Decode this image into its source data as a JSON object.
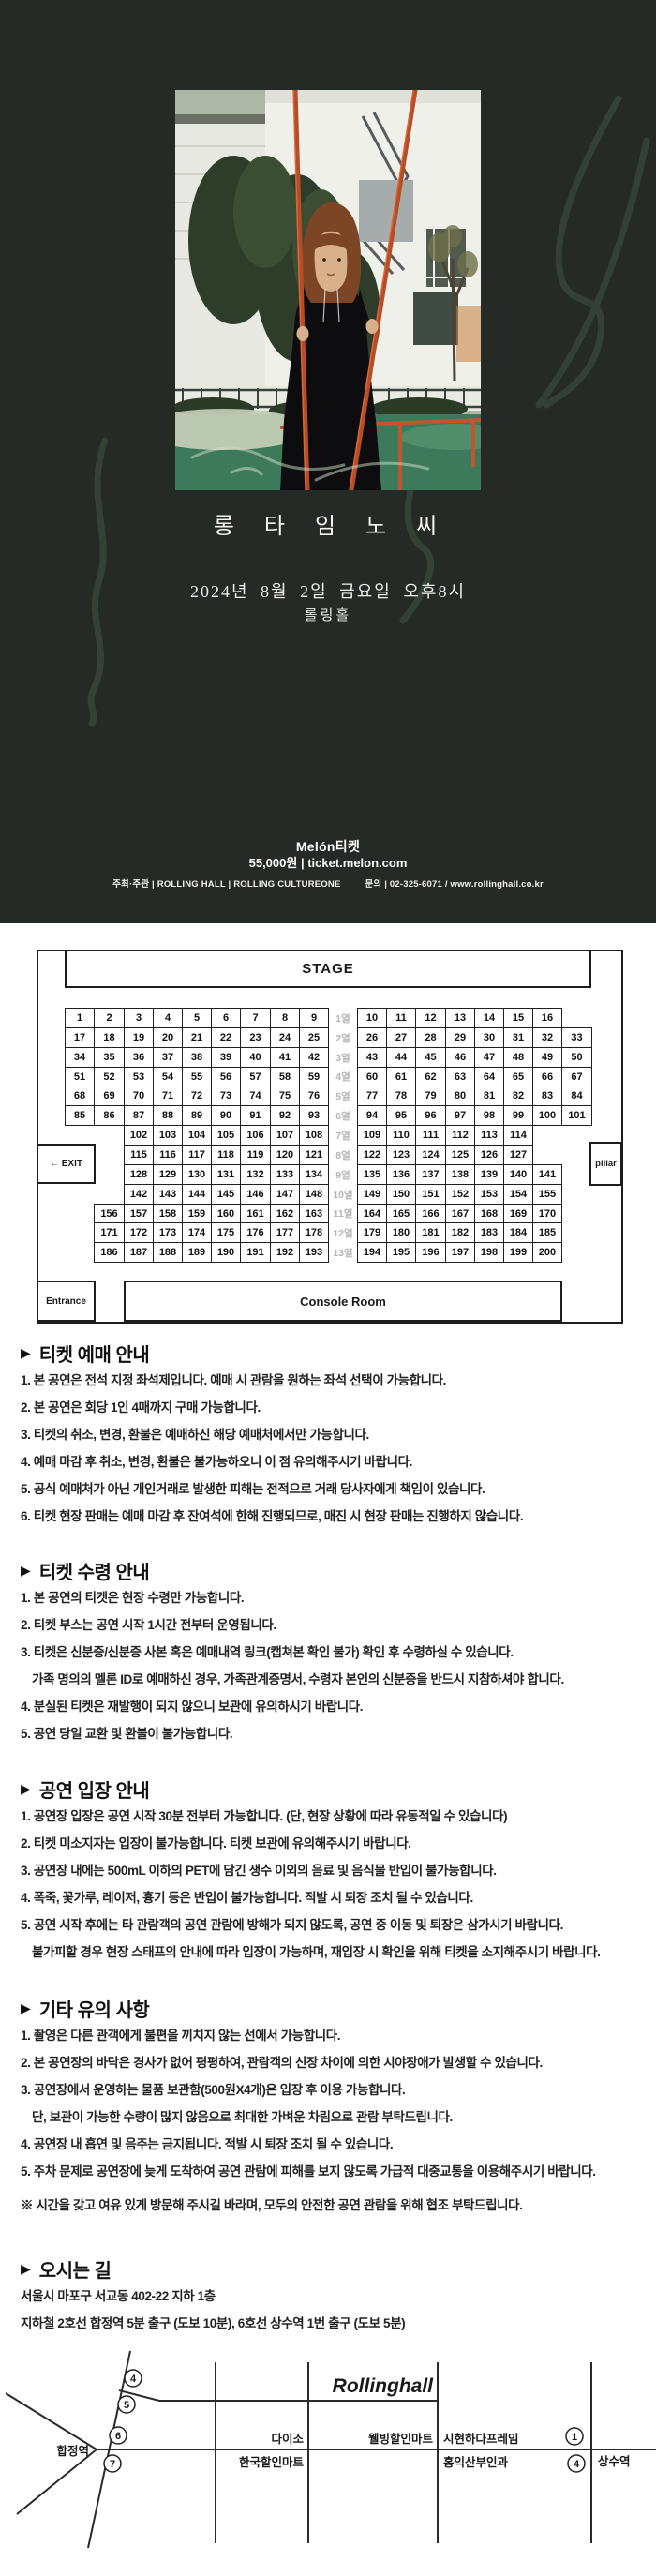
{
  "hero": {
    "title": "롱 타 임 노 씨",
    "date": "2024년 8월 2일 금요일 오후8시",
    "venue": "롤링홀",
    "brand": "Melón티켓",
    "price_line": "55,000원 | ticket.melon.com",
    "credits_left": "주최·주관 | ROLLING HALL | ROLLING CULTUREONE",
    "credits_right": "문의 | 02-325-6071 / www.rollinghall.co.kr"
  },
  "seatmap": {
    "stage_label": "STAGE",
    "exit_label": "← EXIT",
    "pillar_label": "pillar",
    "entrance_label": "Entrance",
    "console_label": "Console Room",
    "rows": [
      {
        "label": "1열",
        "left": [
          1,
          2,
          3,
          4,
          5,
          6,
          7,
          8,
          9
        ],
        "right": [
          10,
          11,
          12,
          13,
          14,
          15,
          16
        ]
      },
      {
        "label": "2열",
        "left": [
          17,
          18,
          19,
          20,
          21,
          22,
          23,
          24,
          25
        ],
        "right": [
          26,
          27,
          28,
          29,
          30,
          31,
          32,
          33
        ]
      },
      {
        "label": "3열",
        "left": [
          34,
          35,
          36,
          37,
          38,
          39,
          40,
          41,
          42
        ],
        "right": [
          43,
          44,
          45,
          46,
          47,
          48,
          49,
          50
        ]
      },
      {
        "label": "4열",
        "left": [
          51,
          52,
          53,
          54,
          55,
          56,
          57,
          58,
          59
        ],
        "right": [
          60,
          61,
          62,
          63,
          64,
          65,
          66,
          67
        ]
      },
      {
        "label": "5열",
        "left": [
          68,
          69,
          70,
          71,
          72,
          73,
          74,
          75,
          76
        ],
        "right": [
          77,
          78,
          79,
          80,
          81,
          82,
          83,
          84
        ]
      },
      {
        "label": "6열",
        "left": [
          85,
          86,
          87,
          88,
          89,
          90,
          91,
          92,
          93
        ],
        "right": [
          94,
          95,
          96,
          97,
          98,
          99,
          100,
          101
        ]
      },
      {
        "label": "7열",
        "left": [
          102,
          103,
          104,
          105,
          106,
          107,
          108
        ],
        "right": [
          109,
          110,
          111,
          112,
          113,
          114
        ]
      },
      {
        "label": "8열",
        "left": [
          115,
          116,
          117,
          118,
          119,
          120,
          121
        ],
        "right": [
          122,
          123,
          124,
          125,
          126,
          127
        ]
      },
      {
        "label": "9열",
        "left": [
          128,
          129,
          130,
          131,
          132,
          133,
          134
        ],
        "right": [
          135,
          136,
          137,
          138,
          139,
          140,
          141
        ]
      },
      {
        "label": "10열",
        "left": [
          142,
          143,
          144,
          145,
          146,
          147,
          148
        ],
        "right": [
          149,
          150,
          151,
          152,
          153,
          154,
          155
        ]
      },
      {
        "label": "11열",
        "left": [
          156,
          157,
          158,
          159,
          160,
          161,
          162,
          163
        ],
        "right": [
          164,
          165,
          166,
          167,
          168,
          169,
          170
        ]
      },
      {
        "label": "12열",
        "left": [
          171,
          172,
          173,
          174,
          175,
          176,
          177,
          178
        ],
        "right": [
          179,
          180,
          181,
          182,
          183,
          184,
          185
        ]
      },
      {
        "label": "13열",
        "left": [
          186,
          187,
          188,
          189,
          190,
          191,
          192,
          193
        ],
        "right": [
          194,
          195,
          196,
          197,
          198,
          199,
          200
        ]
      }
    ]
  },
  "sections": [
    {
      "title": "티켓 예매 안내",
      "items": [
        {
          "text": "1. 본 공연은 전석 지정 좌석제입니다. 예매 시 관람을 원하는 좌석 선택이 가능합니다."
        },
        {
          "text": "2. 본 공연은 회당 1인 4매까지 구매 가능합니다."
        },
        {
          "text": "3. 티켓의 취소, 변경, 환불은 예매하신 해당 예매처에서만 가능합니다."
        },
        {
          "text": "4. 예매 마감 후 취소, 변경, 환불은 불가능하오니 이 점 유의해주시기 바랍니다."
        },
        {
          "text": "5. 공식 예매처가 아닌 개인거래로 발생한 피해는 전적으로 거래 당사자에게 책임이 있습니다."
        },
        {
          "text": "6. 티켓 현장 판매는 예매 마감 후 잔여석에 한해 진행되므로, 매진 시 현장 판매는 진행하지 않습니다."
        }
      ]
    },
    {
      "title": "티켓 수령 안내",
      "items": [
        {
          "text": "1. 본 공연의 티켓은 현장 수령만 가능합니다."
        },
        {
          "text": "2. 티켓 부스는 공연 시작 1시간 전부터 운영됩니다."
        },
        {
          "text": "3. 티켓은 신분증/신분증 사본 혹은 예매내역 링크(캡쳐본 확인 불가) 확인 후 수령하실 수 있습니다."
        },
        {
          "text": "가족 명의의 멜론 ID로 예매하신 경우, 가족관계증명서, 수령자 본인의 신분증을 반드시 지참하셔야 합니다.",
          "indent": true
        },
        {
          "text": "4. 분실된 티켓은 재발행이 되지 않으니 보관에 유의하시기 바랍니다."
        },
        {
          "text": "5. 공연 당일 교환 및 환불이 불가능합니다."
        }
      ]
    },
    {
      "title": "공연 입장 안내",
      "items": [
        {
          "text": "1. 공연장 입장은 공연 시작 30분 전부터 가능합니다. (단, 현장 상황에 따라 유동적일 수 있습니다)"
        },
        {
          "text": "2. 티켓 미소지자는 입장이 불가능합니다. 티켓 보관에 유의해주시기 바랍니다."
        },
        {
          "text": "3. 공연장 내에는 500mL 이하의 PET에 담긴 생수 이외의 음료 및 음식물 반입이 불가능합니다."
        },
        {
          "text": "4. 폭죽, 꽃가루, 레이저, 흉기 등은 반입이 불가능합니다. 적발 시 퇴장 조치 될 수 있습니다."
        },
        {
          "text": "5. 공연 시작 후에는 타 관람객의 공연 관람에 방해가 되지 않도록, 공연 중 이동 및 퇴장은 삼가시기 바랍니다."
        },
        {
          "text": "불가피할 경우 현장 스태프의 안내에 따라 입장이 가능하며, 재입장 시 확인을 위해 티켓을 소지해주시기 바랍니다.",
          "indent": true
        }
      ]
    },
    {
      "title": "기타 유의 사항",
      "items": [
        {
          "text": "1. 촬영은 다른 관객에게 불편을 끼치지 않는 선에서 가능합니다."
        },
        {
          "text": "2. 본 공연장의 바닥은 경사가 없어 평평하여, 관람객의 신장 차이에 의한 시야장애가 발생할 수 있습니다."
        },
        {
          "text": "3. 공연장에서 운영하는 물품 보관함(500원X4개)은 입장 후 이용 가능합니다."
        },
        {
          "text": "단, 보관이 가능한 수량이 많지 않음으로 최대한 가벼운 차림으로 관람 부탁드립니다.",
          "indent": true
        },
        {
          "text": "4. 공연장 내 흡연 및 음주는 금지됩니다. 적발 시 퇴장 조치 될 수 있습니다."
        },
        {
          "text": "5. 주차 문제로 공연장에 늦게 도착하여 공연 관람에 피해를 보지 않도록 가급적 대중교통을 이용해주시기 바랍니다."
        }
      ],
      "note": "※ 시간을 갖고 여유 있게 방문해 주시길 바라며, 모두의 안전한 공연 관람을 위해 협조 부탁드립니다."
    }
  ],
  "directions": {
    "title": "오시는 길",
    "address": "서울시 마포구 서교동 402-22 지하 1층",
    "subway": "지하철 2호선 합정역 5분 출구 (도보 10분), 6호선 상수역 1번 출구 (도보 5분)"
  },
  "map": {
    "logo": "Rollinghall",
    "station_left": "합정역",
    "station_right": "상수역",
    "exits": [
      "4",
      "5",
      "6",
      "7",
      "1",
      "4"
    ],
    "landmarks": {
      "daiso": "다이소",
      "hanguk": "한국할인마트",
      "wellbeing": "웰빙할인마트",
      "sihyeon": "시현하다프레임",
      "hongik": "홍익산부인과"
    }
  }
}
